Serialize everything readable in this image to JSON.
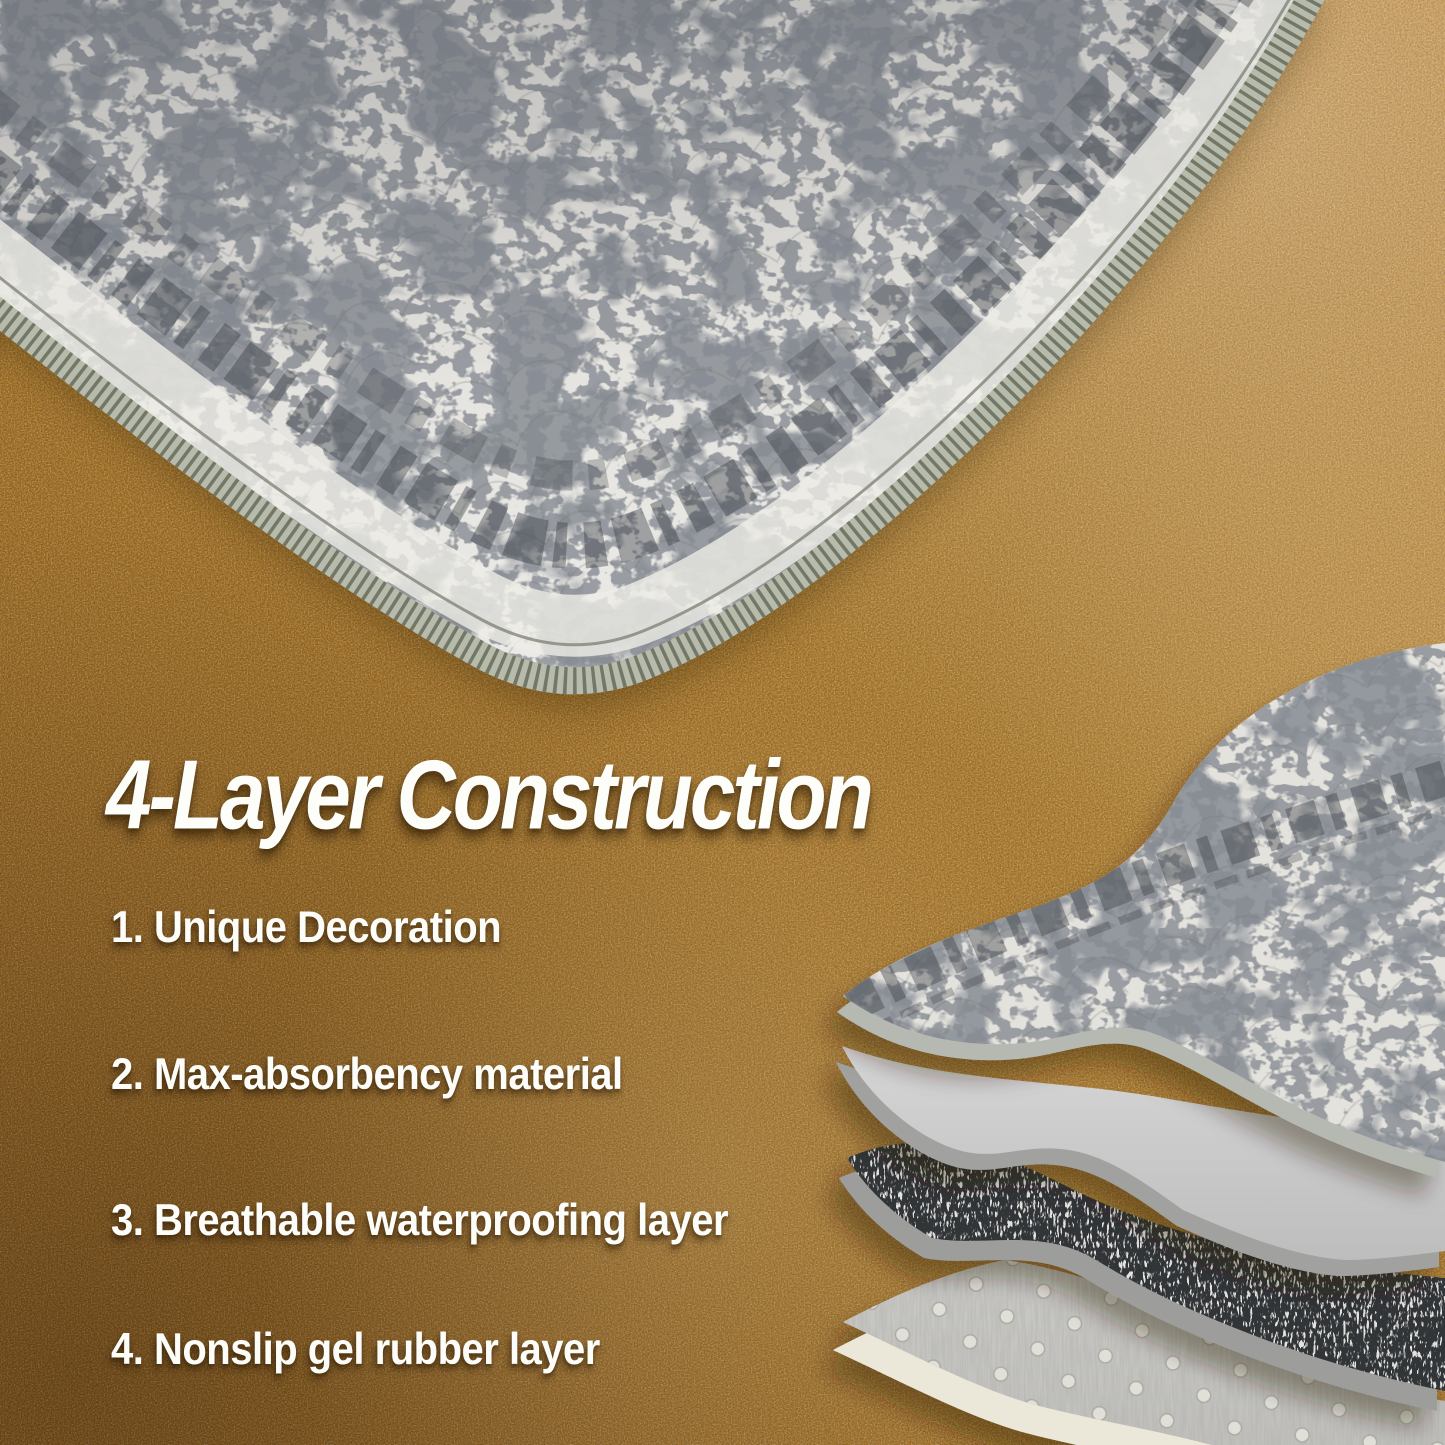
{
  "headline": "4-Layer Construction",
  "features": [
    "1. Unique Decoration",
    "2. Max-absorbency material",
    "3. Breathable waterproofing layer",
    "4. Nonslip gel rubber layer"
  ],
  "colors": {
    "floor_tan": "#a9771f",
    "text_white": "#ffffff",
    "mat_fabric": "#e4e2dd",
    "absorbent_gray": "#c9c9c9",
    "waterproof_dark": "#323437",
    "nonslip_gray": "#c7c6c2",
    "binding_sage": "#b7bbac"
  }
}
